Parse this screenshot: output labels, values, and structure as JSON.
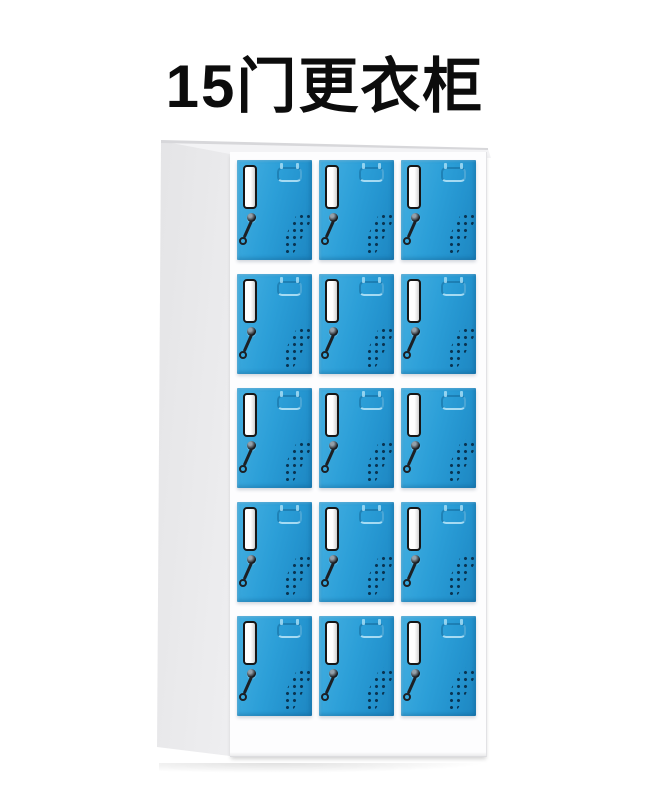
{
  "title": {
    "text": "15门更衣柜"
  },
  "cabinet": {
    "rows": 5,
    "columns": 3,
    "total_doors": 15,
    "colors": {
      "door_blue": "#2c9fd8",
      "door_blue_light": "#46b0e1",
      "door_blue_dark": "#1d86c1",
      "frame_white": "#fdfdfe",
      "side_panel": "#efeff1",
      "label_card": "#ffffff",
      "label_border": "#161616",
      "vent_dot": "#093452",
      "key_metal": "#1c2025"
    },
    "door_part_names": [
      "card-label-slot",
      "recessed-handle",
      "keyhole-lock",
      "hanging-key",
      "vent-holes"
    ]
  }
}
